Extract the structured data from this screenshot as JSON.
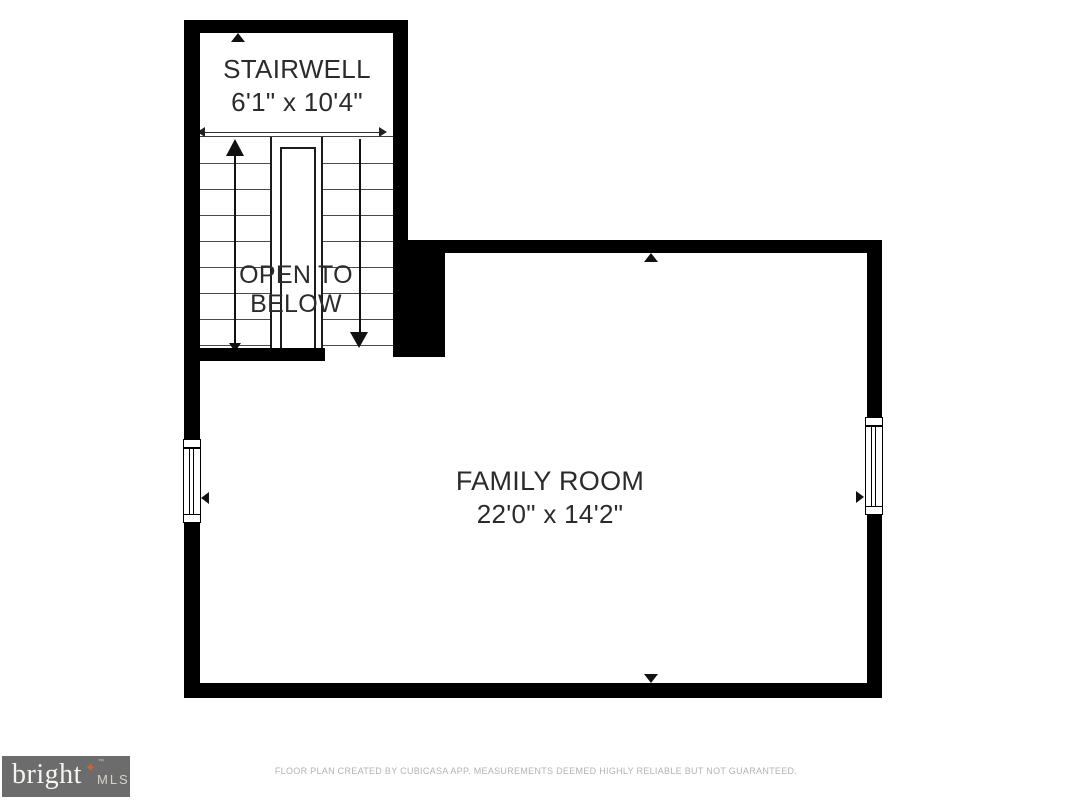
{
  "floor_plan": {
    "rooms": [
      {
        "id": "stairwell",
        "name": "STAIRWELL",
        "dimensions": "6'1\" x 10'4\""
      },
      {
        "id": "family-room",
        "name": "FAMILY ROOM",
        "dimensions": "22'0\" x 14'2\""
      }
    ],
    "annotations": {
      "open_to_below": "OPEN TO BELOW"
    },
    "features": {
      "windows": [
        "left-wall-window",
        "right-wall-window"
      ],
      "stair_arrows": [
        "up-arrow",
        "down-arrow"
      ]
    },
    "colors": {
      "wall": "#000000",
      "label_text": "#2b2b2b",
      "stair_line": "#4a4a4a",
      "footer_text": "#b5b3b1",
      "logo_background": "#6c6c6c",
      "logo_star": "#d4603c"
    }
  },
  "footer": {
    "logo": {
      "brand": "bright",
      "suffix": "MLS",
      "tm": "™",
      "star": "✦"
    },
    "disclaimer": "FLOOR PLAN CREATED BY CUBICASA APP. MEASUREMENTS DEEMED HIGHLY RELIABLE BUT NOT GUARANTEED."
  }
}
